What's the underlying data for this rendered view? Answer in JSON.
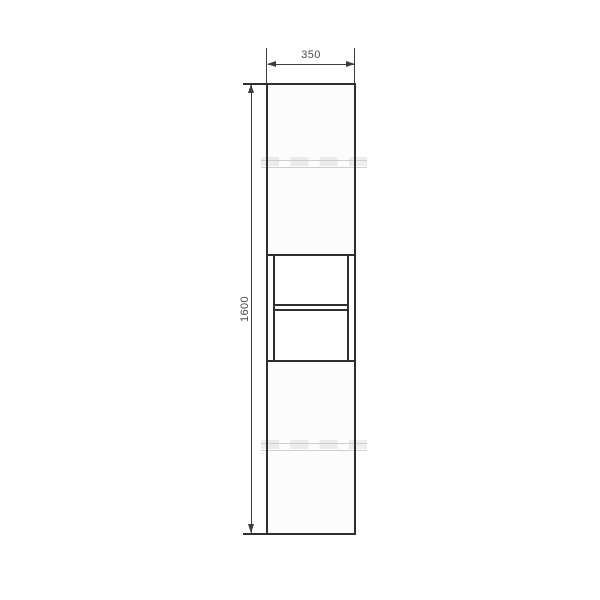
{
  "drawing": {
    "labels": {
      "width": "350",
      "height": "1600"
    },
    "colors": {
      "line": "#2f2f2f",
      "dim": "#3d3d3d",
      "text": "#4a4a4a",
      "panel": "#fcfcfc",
      "watermark": "#cfcfcf",
      "background": "#ffffff"
    }
  }
}
